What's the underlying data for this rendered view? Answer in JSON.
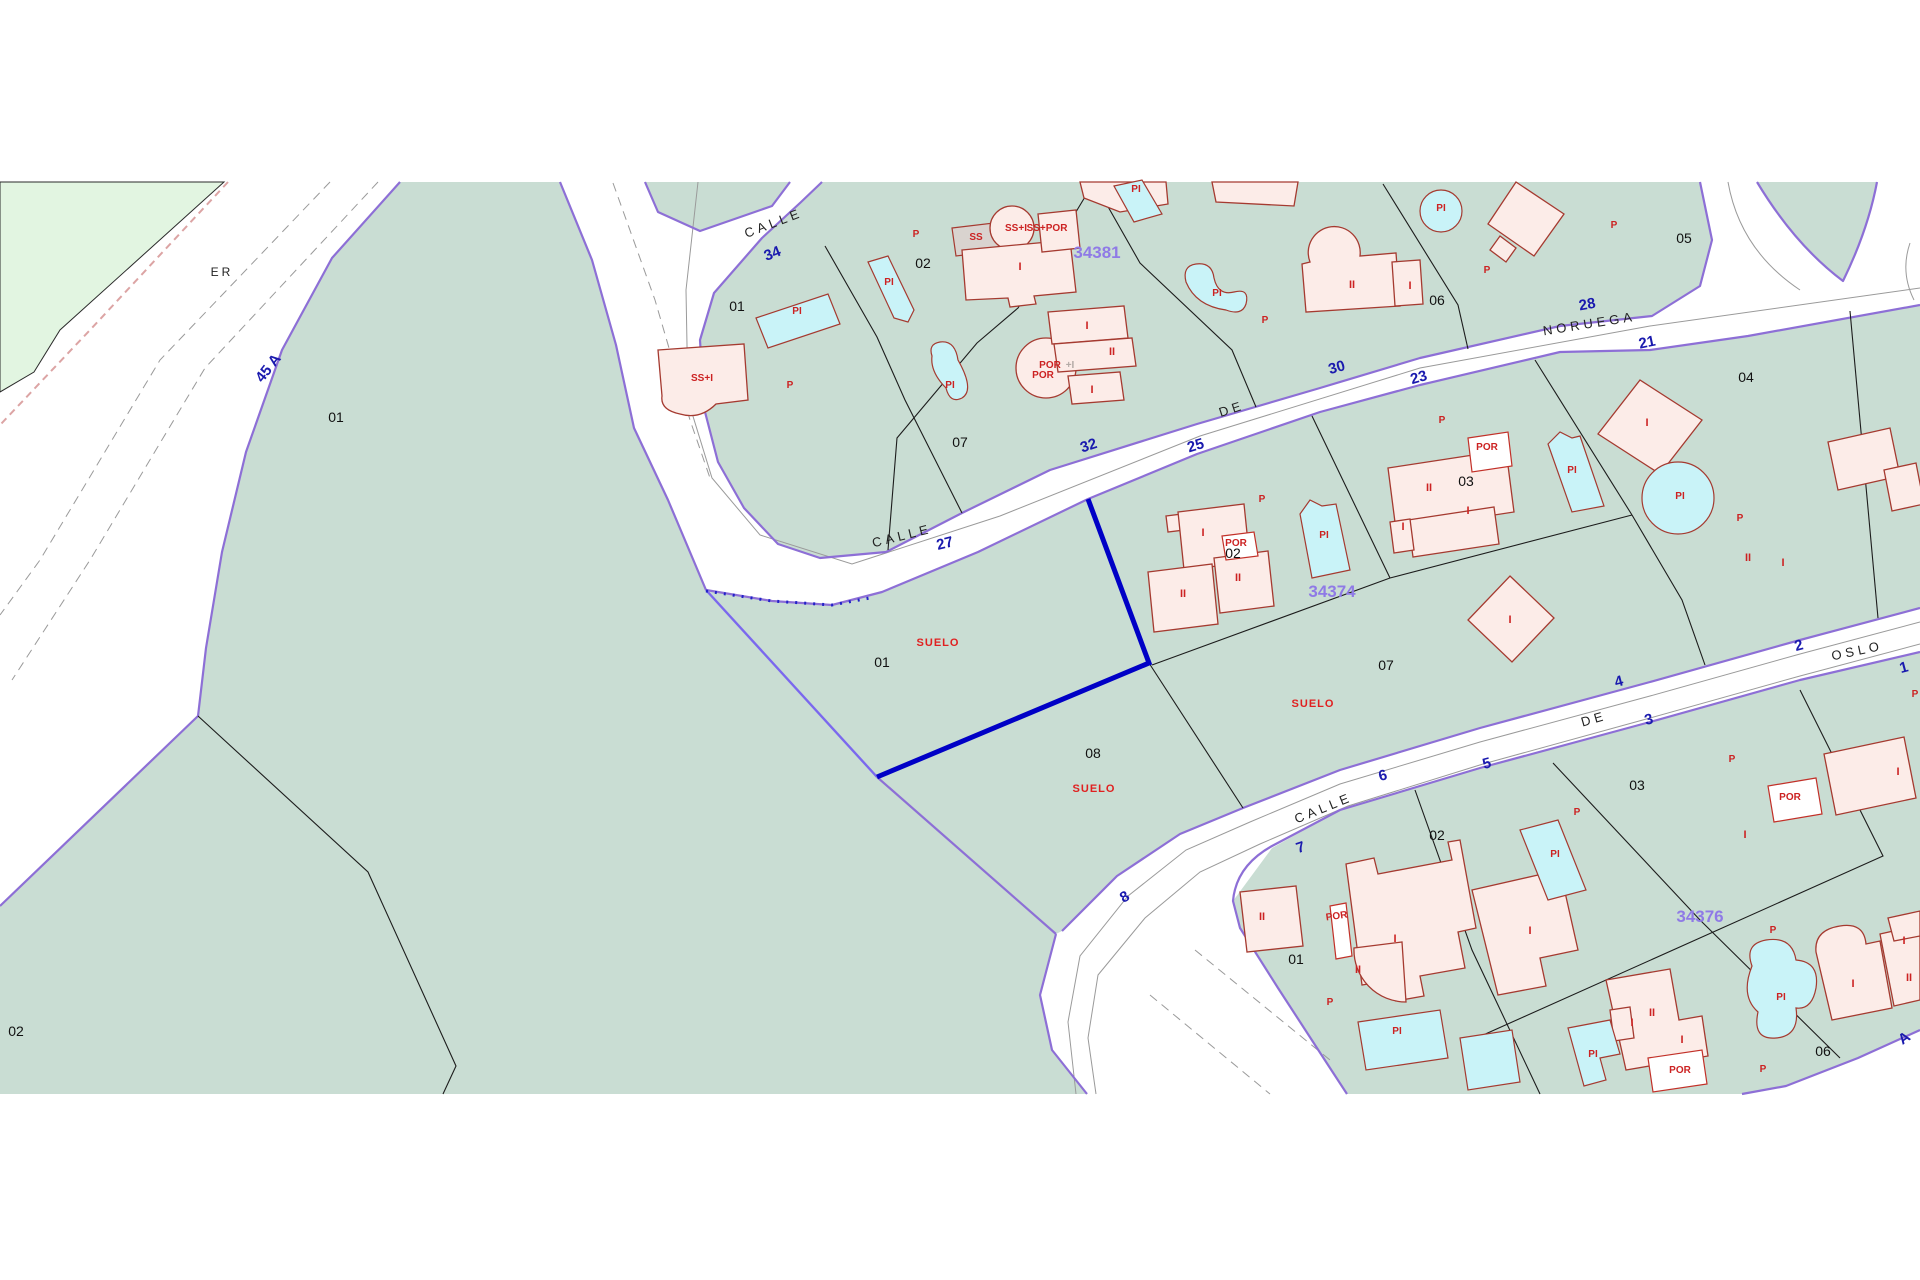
{
  "map": {
    "type": "cadastral-parcel-map",
    "colors": {
      "parcel_fill": "#c9ddd3",
      "greenery_fill": "#e2f5e1",
      "boundary_purple": "#8d6fd6",
      "selected_parcel_outline": "#0000c6",
      "building_fill": "#fcece8",
      "building_stroke": "#a53a30",
      "pool_fill": "#c9f3f8",
      "street_number_blue": "#1a1aae",
      "block_code_purple": "#8f7ae6",
      "label_red": "#cc2222",
      "background": "#ffffff"
    },
    "labels": {
      "street_names": [
        {
          "t": "CALLE",
          "x": 775,
          "y": 227,
          "r": -21
        },
        {
          "t": "DE",
          "x": 1233,
          "y": 413,
          "r": -18
        },
        {
          "t": "NORUEGA",
          "x": 1590,
          "y": 328,
          "r": -9
        },
        {
          "t": "CALLE",
          "x": 903,
          "y": 540,
          "r": -14
        },
        {
          "t": "CALLE",
          "x": 1325,
          "y": 812,
          "r": -22
        },
        {
          "t": "DE",
          "x": 1595,
          "y": 723,
          "r": -16
        },
        {
          "t": "OSLO",
          "x": 1858,
          "y": 655,
          "r": -12
        },
        {
          "t": "ER",
          "x": 222,
          "y": 276,
          "r": 0
        }
      ],
      "street_numbers": [
        {
          "t": "34",
          "x": 774,
          "y": 258,
          "r": -21
        },
        {
          "t": "32",
          "x": 1090,
          "y": 450,
          "r": -18
        },
        {
          "t": "30",
          "x": 1338,
          "y": 372,
          "r": -16
        },
        {
          "t": "28",
          "x": 1588,
          "y": 309,
          "r": -10
        },
        {
          "t": "27",
          "x": 946,
          "y": 548,
          "r": -14
        },
        {
          "t": "25",
          "x": 1197,
          "y": 450,
          "r": -17
        },
        {
          "t": "23",
          "x": 1420,
          "y": 382,
          "r": -16
        },
        {
          "t": "21",
          "x": 1648,
          "y": 347,
          "r": -12
        },
        {
          "t": "2",
          "x": 1800,
          "y": 650,
          "r": -15
        },
        {
          "t": "1",
          "x": 1905,
          "y": 672,
          "r": -15
        },
        {
          "t": "4",
          "x": 1620,
          "y": 686,
          "r": -15
        },
        {
          "t": "3",
          "x": 1650,
          "y": 724,
          "r": -15
        },
        {
          "t": "5",
          "x": 1488,
          "y": 768,
          "r": -15
        },
        {
          "t": "6",
          "x": 1384,
          "y": 780,
          "r": -15
        },
        {
          "t": "7",
          "x": 1302,
          "y": 852,
          "r": -18
        },
        {
          "t": "8",
          "x": 1127,
          "y": 901,
          "r": -30
        },
        {
          "t": "45 A",
          "x": 272,
          "y": 371,
          "r": -52
        },
        {
          "t": "A",
          "x": 1907,
          "y": 1042,
          "r": -35
        }
      ],
      "block_codes": [
        {
          "t": "34381",
          "x": 1097,
          "y": 258,
          "r": 0
        },
        {
          "t": "34374",
          "x": 1332,
          "y": 597,
          "r": 0
        },
        {
          "t": "34376",
          "x": 1700,
          "y": 922,
          "r": 0
        }
      ],
      "parcel_numbers": [
        {
          "t": "01",
          "x": 336,
          "y": 422,
          "r": 0
        },
        {
          "t": "02",
          "x": 16,
          "y": 1036,
          "r": 0
        },
        {
          "t": "01",
          "x": 737,
          "y": 311,
          "r": 0
        },
        {
          "t": "02",
          "x": 923,
          "y": 268,
          "r": 0
        },
        {
          "t": "07",
          "x": 960,
          "y": 447,
          "r": 0
        },
        {
          "t": "06",
          "x": 1437,
          "y": 305,
          "r": 0
        },
        {
          "t": "05",
          "x": 1684,
          "y": 243,
          "r": 0
        },
        {
          "t": "01",
          "x": 882,
          "y": 667,
          "r": 0
        },
        {
          "t": "02",
          "x": 1233,
          "y": 558,
          "r": 0
        },
        {
          "t": "03",
          "x": 1466,
          "y": 486,
          "r": 0
        },
        {
          "t": "04",
          "x": 1746,
          "y": 382,
          "r": 0
        },
        {
          "t": "07",
          "x": 1386,
          "y": 670,
          "r": 0
        },
        {
          "t": "08",
          "x": 1093,
          "y": 758,
          "r": 0
        },
        {
          "t": "01",
          "x": 1296,
          "y": 964,
          "r": 0
        },
        {
          "t": "02",
          "x": 1437,
          "y": 840,
          "r": 0
        },
        {
          "t": "03",
          "x": 1637,
          "y": 790,
          "r": 0
        },
        {
          "t": "06",
          "x": 1823,
          "y": 1056,
          "r": 0
        }
      ],
      "land_use": [
        {
          "t": "SUELO",
          "x": 938,
          "y": 646,
          "r": 0
        },
        {
          "t": "SUELO",
          "x": 1313,
          "y": 707,
          "r": 0
        },
        {
          "t": "SUELO",
          "x": 1094,
          "y": 792,
          "r": 0
        }
      ],
      "building_marks": [
        {
          "t": "PI",
          "x": 797,
          "y": 314,
          "r": 0
        },
        {
          "t": "PI",
          "x": 889,
          "y": 285,
          "r": 0
        },
        {
          "t": "PI",
          "x": 950,
          "y": 388,
          "r": 0
        },
        {
          "t": "PI",
          "x": 1136,
          "y": 192,
          "r": 0
        },
        {
          "t": "PI",
          "x": 1217,
          "y": 296,
          "r": 0
        },
        {
          "t": "PI",
          "x": 1441,
          "y": 211,
          "r": 0
        },
        {
          "t": "PI",
          "x": 1324,
          "y": 538,
          "r": 0
        },
        {
          "t": "PI",
          "x": 1572,
          "y": 473,
          "r": 0
        },
        {
          "t": "PI",
          "x": 1680,
          "y": 499,
          "r": 0
        },
        {
          "t": "PI",
          "x": 1397,
          "y": 1034,
          "r": 0
        },
        {
          "t": "PI",
          "x": 1555,
          "y": 857,
          "r": 0
        },
        {
          "t": "PI",
          "x": 1593,
          "y": 1057,
          "r": 0
        },
        {
          "t": "PI",
          "x": 1781,
          "y": 1000,
          "r": 0
        },
        {
          "t": "POR",
          "x": 1043,
          "y": 378,
          "r": 0
        },
        {
          "t": "POR",
          "x": 1050,
          "y": 368,
          "r": 0
        },
        {
          "t": "POR",
          "x": 1487,
          "y": 450,
          "r": 0
        },
        {
          "t": "POR",
          "x": 1236,
          "y": 546,
          "r": 0
        },
        {
          "t": "POR",
          "x": 1790,
          "y": 800,
          "r": 0
        },
        {
          "t": "POR",
          "x": 1337,
          "y": 919,
          "r": -8
        },
        {
          "t": "POR",
          "x": 1680,
          "y": 1073,
          "r": 0
        },
        {
          "t": "P",
          "x": 790,
          "y": 388,
          "r": 0
        },
        {
          "t": "P",
          "x": 916,
          "y": 237,
          "r": 0
        },
        {
          "t": "P",
          "x": 1265,
          "y": 323,
          "r": 0
        },
        {
          "t": "P",
          "x": 1487,
          "y": 273,
          "r": 0
        },
        {
          "t": "P",
          "x": 1614,
          "y": 228,
          "r": 0
        },
        {
          "t": "P",
          "x": 1740,
          "y": 521,
          "r": 0
        },
        {
          "t": "P",
          "x": 1442,
          "y": 423,
          "r": 0
        },
        {
          "t": "P",
          "x": 1262,
          "y": 502,
          "r": 0
        },
        {
          "t": "P",
          "x": 1732,
          "y": 762,
          "r": 0
        },
        {
          "t": "P",
          "x": 1577,
          "y": 815,
          "r": 0
        },
        {
          "t": "P",
          "x": 1773,
          "y": 933,
          "r": 0
        },
        {
          "t": "P",
          "x": 1763,
          "y": 1072,
          "r": 0
        },
        {
          "t": "P",
          "x": 1330,
          "y": 1005,
          "r": 0
        },
        {
          "t": "P",
          "x": 1915,
          "y": 697,
          "r": 0
        },
        {
          "t": "SS",
          "x": 976,
          "y": 240,
          "r": 0
        },
        {
          "t": "SS+I",
          "x": 1016,
          "y": 231,
          "r": 0
        },
        {
          "t": "SS+I",
          "x": 702,
          "y": 381,
          "r": 0
        },
        {
          "t": "SS+POR",
          "x": 1047,
          "y": 231,
          "r": 0
        }
      ],
      "gray_marks": [
        {
          "t": "+I",
          "x": 1070,
          "y": 368,
          "r": 0
        }
      ],
      "floor_marks": [
        {
          "t": "I",
          "x": 1020,
          "y": 270,
          "r": 0
        },
        {
          "t": "I",
          "x": 1087,
          "y": 329,
          "r": 0
        },
        {
          "t": "II",
          "x": 1112,
          "y": 355,
          "r": 0
        },
        {
          "t": "I",
          "x": 1092,
          "y": 393,
          "r": 0
        },
        {
          "t": "II",
          "x": 1352,
          "y": 288,
          "r": 0
        },
        {
          "t": "I",
          "x": 1410,
          "y": 289,
          "r": 0
        },
        {
          "t": "I",
          "x": 1203,
          "y": 536,
          "r": 0
        },
        {
          "t": "II",
          "x": 1183,
          "y": 597,
          "r": 0
        },
        {
          "t": "II",
          "x": 1238,
          "y": 581,
          "r": 0
        },
        {
          "t": "II",
          "x": 1429,
          "y": 491,
          "r": 0
        },
        {
          "t": "I",
          "x": 1468,
          "y": 514,
          "r": 0
        },
        {
          "t": "I",
          "x": 1403,
          "y": 530,
          "r": 0
        },
        {
          "t": "I",
          "x": 1647,
          "y": 426,
          "r": 0
        },
        {
          "t": "II",
          "x": 1748,
          "y": 561,
          "r": 0
        },
        {
          "t": "I",
          "x": 1783,
          "y": 566,
          "r": 0
        },
        {
          "t": "I",
          "x": 1510,
          "y": 623,
          "r": 0
        },
        {
          "t": "II",
          "x": 1262,
          "y": 920,
          "r": 0
        },
        {
          "t": "I",
          "x": 1395,
          "y": 942,
          "r": 0
        },
        {
          "t": "II",
          "x": 1358,
          "y": 973,
          "r": 0
        },
        {
          "t": "I",
          "x": 1530,
          "y": 934,
          "r": 0
        },
        {
          "t": "II",
          "x": 1652,
          "y": 1016,
          "r": 0
        },
        {
          "t": "I",
          "x": 1682,
          "y": 1043,
          "r": 0
        },
        {
          "t": "I",
          "x": 1632,
          "y": 1026,
          "r": 0
        },
        {
          "t": "I",
          "x": 1853,
          "y": 987,
          "r": 0
        },
        {
          "t": "II",
          "x": 1909,
          "y": 981,
          "r": 0
        },
        {
          "t": "I",
          "x": 1904,
          "y": 944,
          "r": 0
        },
        {
          "t": "I",
          "x": 1898,
          "y": 775,
          "r": 0
        },
        {
          "t": "I",
          "x": 1745,
          "y": 838,
          "r": 0
        }
      ]
    }
  }
}
